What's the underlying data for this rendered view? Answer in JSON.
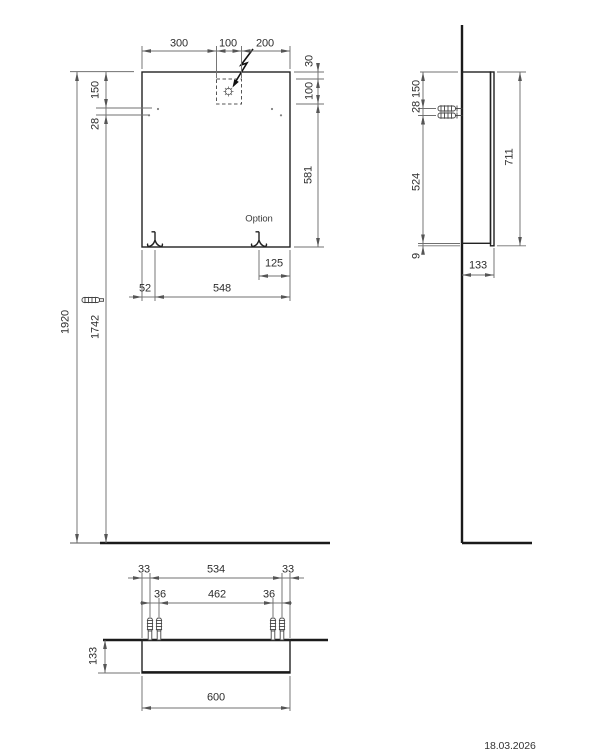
{
  "drawing": {
    "kind": "installation technical drawing, three views",
    "date": "18.03.2026",
    "front": {
      "top_width_dims": [
        "300",
        "100",
        "200"
      ],
      "right_height_dims": [
        "30",
        "100",
        "581"
      ],
      "left_offset_dims": [
        "150",
        "28"
      ],
      "overall_height_dims": [
        "1920",
        "1742"
      ],
      "bottom_dims": [
        "125",
        "52",
        "548"
      ],
      "option_label": "Option"
    },
    "side": {
      "left_dims": [
        "150",
        "28",
        "524",
        "9"
      ],
      "height_dim": "711",
      "depth_dim": "133"
    },
    "plan": {
      "outer_dims": [
        "33",
        "534",
        "33"
      ],
      "inner_dims": [
        "36",
        "462",
        "36"
      ],
      "depth_dim": "133",
      "width_dim": "600"
    }
  }
}
